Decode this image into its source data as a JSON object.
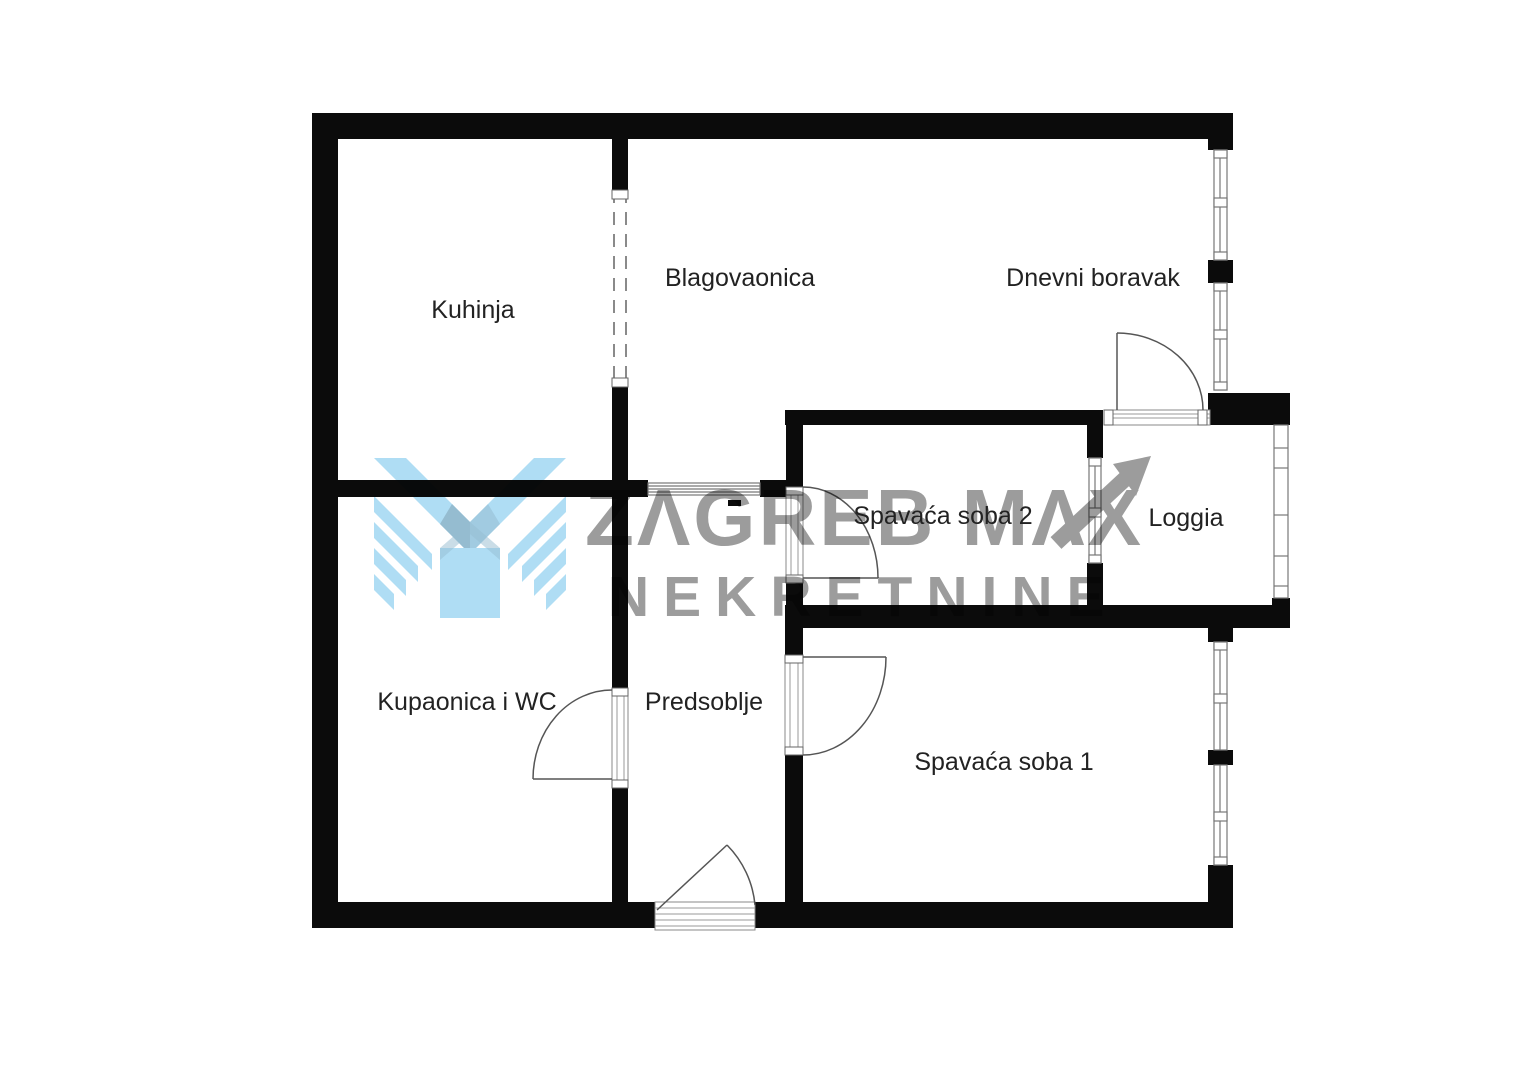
{
  "plan": {
    "type": "apartment-floor-plan",
    "rooms": [
      {
        "name": "kuhinja",
        "label": "Kuhinja"
      },
      {
        "name": "blagovaonica",
        "label": "Blagovaonica"
      },
      {
        "name": "dnevni-boravak",
        "label": "Dnevni boravak"
      },
      {
        "name": "spavaca-soba-2",
        "label": "Spavaća soba 2"
      },
      {
        "name": "loggia",
        "label": "Loggia"
      },
      {
        "name": "kupaonica-i-wc",
        "label": "Kupaonica i WC"
      },
      {
        "name": "predsoblje",
        "label": "Predsoblje"
      },
      {
        "name": "spavaca-soba-1",
        "label": "Spavaća soba 1"
      }
    ],
    "colors": {
      "wall": "#0b0b0b",
      "room_label": "#222222",
      "detail_line": "#777777",
      "watermark_gray": "#9c9c9c",
      "watermark_blue": "#a9dbf4",
      "watermark_blue_shade": "#8db7cd"
    }
  },
  "watermark": {
    "brand_line1": "ZAGREB MAX",
    "brand_line1_display": "ZΛGREB MΛX",
    "brand_line2": "NEKRETNINE"
  }
}
